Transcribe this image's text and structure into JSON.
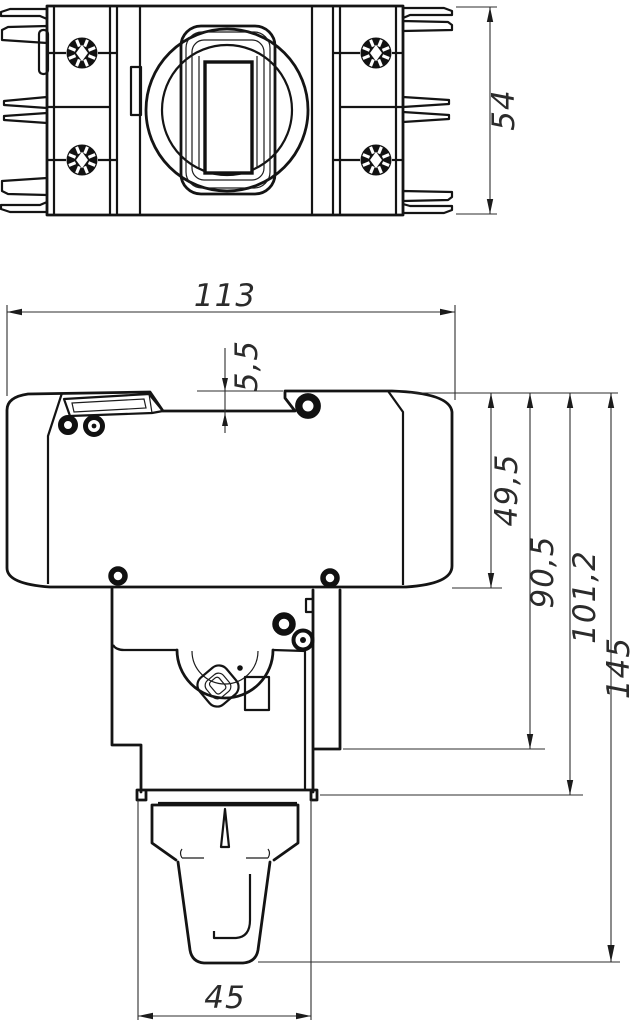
{
  "drawing": {
    "background": "#ffffff",
    "line_color": "#141414",
    "dimension_color": "#2e2e2e",
    "dimensions": {
      "top_view_height": "54",
      "front_width": "113",
      "top_step": "5,5",
      "upper_body_height": "49,5",
      "flange_height": "90,5",
      "base_plate_height": "101,2",
      "total_height": "145",
      "base_width": "45"
    }
  }
}
